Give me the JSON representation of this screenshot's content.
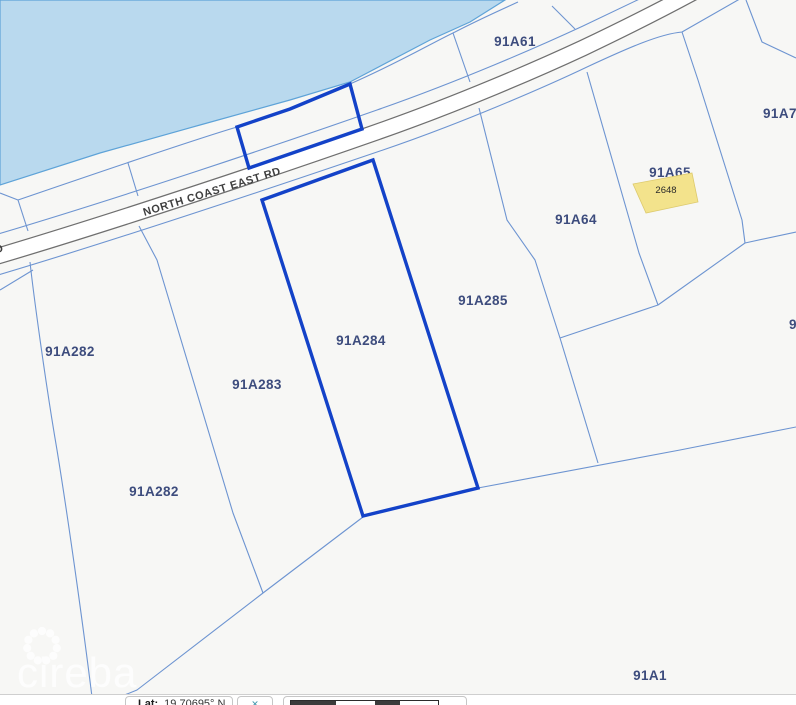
{
  "map": {
    "road_label": "NORTH COAST EAST RD",
    "watermark_text": "cireba",
    "selected_block_number": "2648",
    "colors": {
      "water": "#b9d9ee",
      "water_edge": "#5ea3d8",
      "boundary": "#6d94d1",
      "highlight": "#1342c8",
      "selected_fill": "#f3e38c",
      "label_text": "#3d4c7d",
      "road_casing": "#6f6f6f"
    },
    "labels": [
      {
        "text": "91A61",
        "x": 515,
        "y": 46,
        "cls": "parcel"
      },
      {
        "text": "91A77",
        "x": 763,
        "y": 118,
        "cls": "parcel",
        "anchor": "start"
      },
      {
        "text": "91A65",
        "x": 670,
        "y": 177,
        "cls": "parcel",
        "layer": "under"
      },
      {
        "text": "91A64",
        "x": 576,
        "y": 224,
        "cls": "parcel"
      },
      {
        "text": "91A285",
        "x": 483,
        "y": 305,
        "cls": "parcel"
      },
      {
        "text": "91A284",
        "x": 361,
        "y": 345,
        "cls": "parcel"
      },
      {
        "text": "91A283",
        "x": 257,
        "y": 389,
        "cls": "parcel"
      },
      {
        "text": "91A282",
        "x": 70,
        "y": 356,
        "cls": "parcel"
      },
      {
        "text": "91A282",
        "x": 154,
        "y": 496,
        "cls": "parcel"
      },
      {
        "text": "91A1",
        "x": 650,
        "y": 680,
        "cls": "parcel"
      },
      {
        "text": "9",
        "x": 789,
        "y": 329,
        "cls": "parcel",
        "anchor": "start"
      },
      {
        "text": "2648",
        "x": 666,
        "y": 193,
        "cls": "block"
      },
      {
        "text": "NORTH COAST EAST RD",
        "x": 213,
        "y": 195,
        "cls": "road",
        "rotate": -17
      },
      {
        "text": "RD",
        "x": -12,
        "y": 256,
        "cls": "road",
        "rotate": -17,
        "anchor": "start"
      }
    ]
  },
  "bottom_bar": {
    "lat_label": "Lat:",
    "lat_value": "19.70695° N",
    "toggle_glyph": "✕",
    "scalebar_segments": [
      {
        "w": 45,
        "c": "#3b3b3b"
      },
      {
        "w": 39,
        "c": "#ffffff"
      },
      {
        "w": 25,
        "c": "#3b3b3b"
      },
      {
        "w": 38,
        "c": "#ffffff"
      }
    ]
  }
}
